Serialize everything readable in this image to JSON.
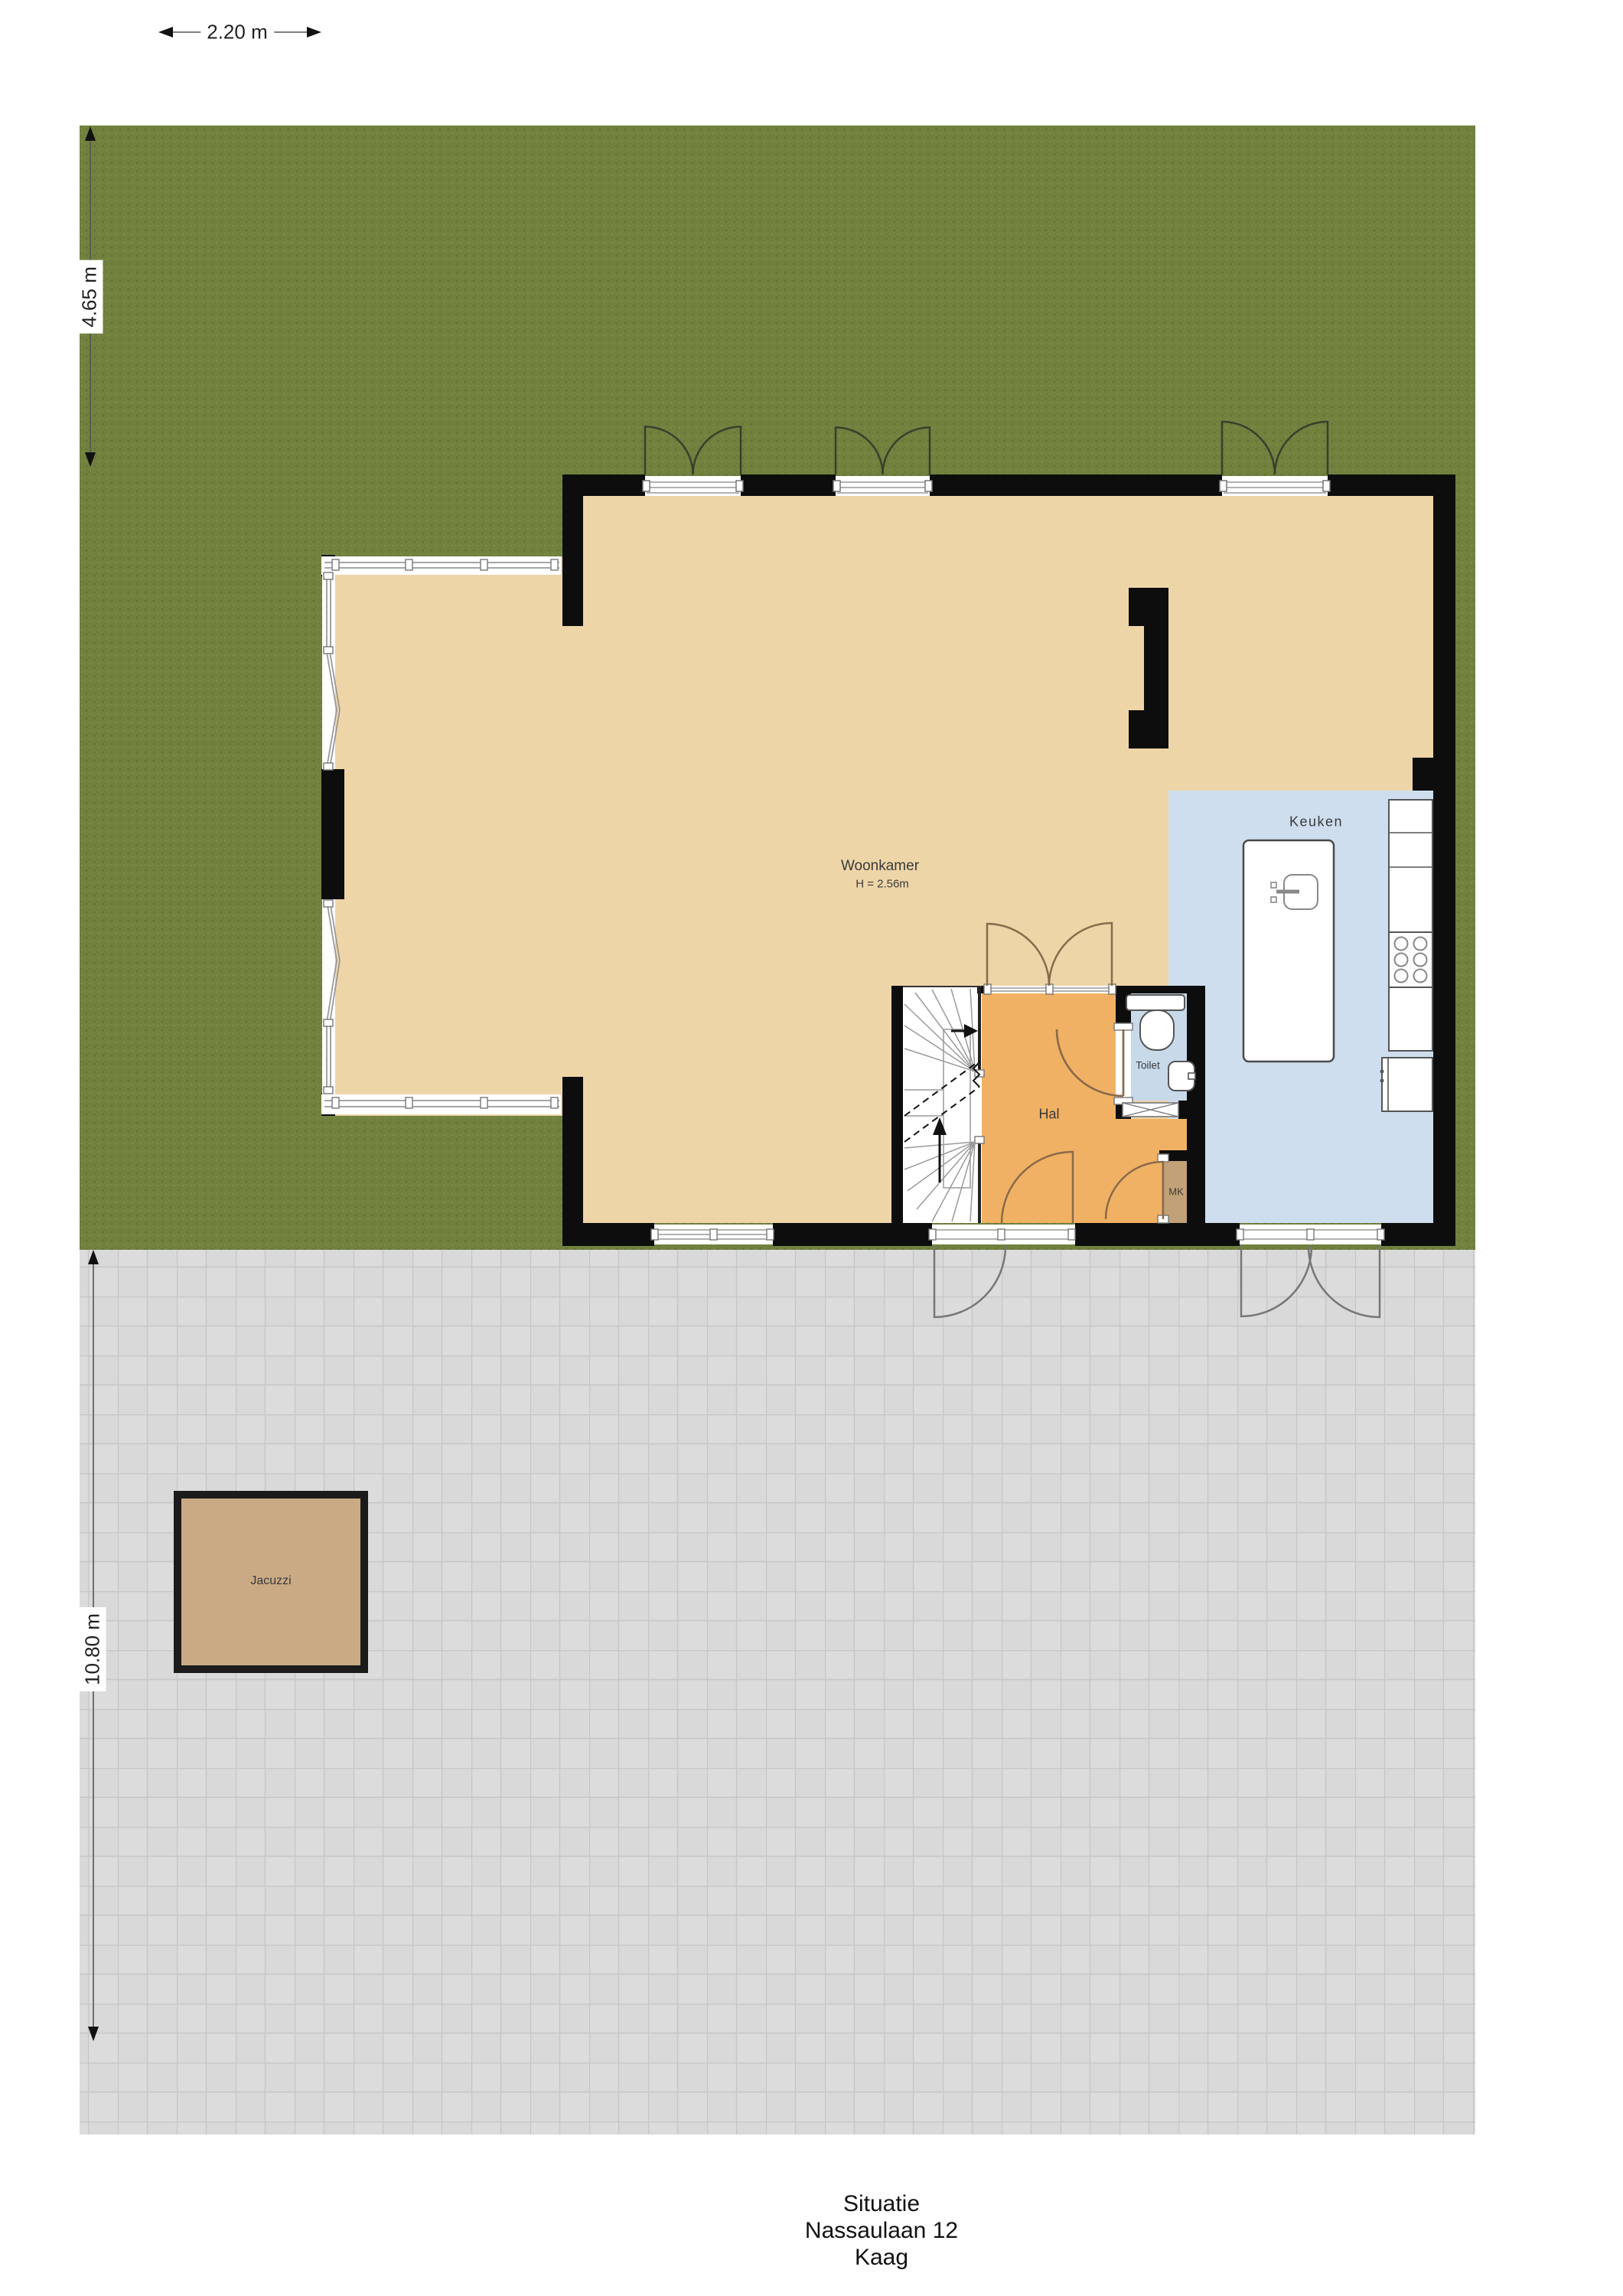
{
  "colors": {
    "grass": "#71813e",
    "grass_dark": "#59692d",
    "grass_light": "#8c9a52",
    "terrace": "#d9d9d9",
    "terrace_line": "#c6c6c6",
    "wall": "#0d0d0d",
    "floor_living": "#eed5a8",
    "floor_hall": "#f0b164",
    "floor_kitchen": "#cfdeee",
    "floor_toilet": "#c8d9ea",
    "floor_mk": "#c2a178",
    "jacuzzi": "#c9aa84",
    "window_line": "#999999",
    "fixture_stroke": "#555555",
    "dim_line": "#555555",
    "label_text": "#3a3a3a",
    "title_text": "#111111"
  },
  "dimensions": {
    "top_width": "2.20 m",
    "garden_depth": "4.65 m",
    "terrace_depth": "10.80 m"
  },
  "rooms": {
    "living": {
      "label": "Woonkamer",
      "ceiling_height": "H = 2.56m"
    },
    "kitchen": {
      "label": "Keuken"
    },
    "hall": {
      "label": "Hal"
    },
    "toilet": {
      "label": "Toilet"
    },
    "meter_cupboard": {
      "label": "MK"
    },
    "jacuzzi": {
      "label": "Jacuzzi"
    }
  },
  "title_block": {
    "plan": "Situatie",
    "address": "Nassaulaan 12",
    "city": "Kaag"
  }
}
